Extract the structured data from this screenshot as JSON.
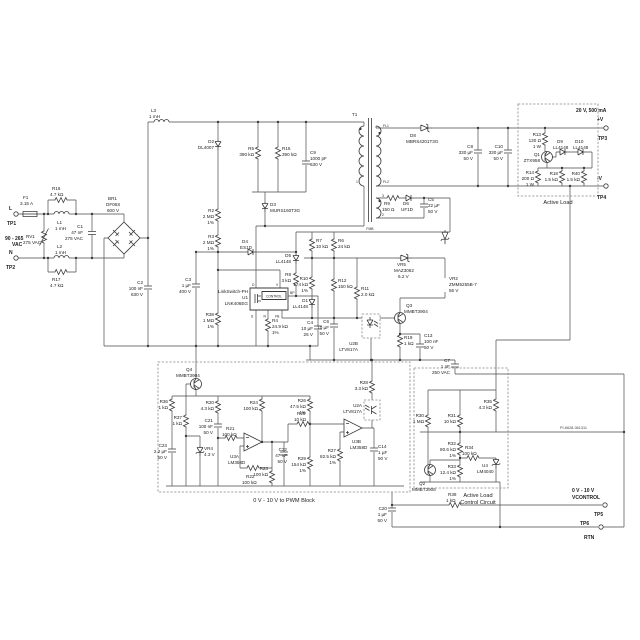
{
  "io": {
    "line": "L",
    "neutral": "N",
    "tp1": "TP1",
    "tp2": "TP2",
    "range1": "90 - 265",
    "range2": "VAC",
    "out_rating": "20 V, 500 mA",
    "out_pos": "+V",
    "tp3": "TP3",
    "out_neg": "-V",
    "tp4": "TP4",
    "ctrl_range": "0 V - 10 V",
    "ctrl_name": "VCONTROL",
    "tp5": "TP5",
    "tp6": "TP6",
    "rtn": "RTN"
  },
  "blocks": {
    "active_load": "Active Load",
    "pwm": "0 V - 10 V to PWM Block",
    "alcc1": "Active Load",
    "alcc2": "Control Circuit"
  },
  "doc": {
    "number": "PI-6628-061311"
  },
  "u1": {
    "brand": "LinkSwitch-PH",
    "ref": "U1",
    "part": "LNK406EG",
    "control": "CONTROL",
    "pin_d": "D",
    "pin_s": "S",
    "pin_bp": "BP",
    "pin_fb": "FB",
    "pin_v": "V",
    "pin_r": "R"
  },
  "t1": {
    "ref": "T1",
    "fl1": "FL1",
    "fl2": "FL2",
    "p1": "1",
    "p2": "2",
    "p3": "3",
    "fmb": "FMB"
  },
  "parts": {
    "F1": {
      "ref": "F1",
      "v1": "3.15 A"
    },
    "RV1": {
      "ref": "RV1",
      "v1": "275 VAC"
    },
    "R16": {
      "ref": "R16",
      "v1": "4.7 kΩ"
    },
    "R17": {
      "ref": "R17",
      "v1": "4.7 kΩ"
    },
    "L1": {
      "ref": "L1",
      "v1": "1 mH"
    },
    "L2": {
      "ref": "L2",
      "v1": "1 mH"
    },
    "L3": {
      "ref": "L3",
      "v1": "1 mH"
    },
    "C1": {
      "ref": "C1",
      "v1": "47 nF",
      "v2": "275 VAC"
    },
    "BR1": {
      "ref": "BR1",
      "v1": "DF06S",
      "v2": "600 V"
    },
    "C2": {
      "ref": "C2",
      "v1": "100 nF",
      "v2": "630 V"
    },
    "D2": {
      "ref": "D2",
      "v1": "DL4007"
    },
    "R2": {
      "ref": "R2",
      "v1": "2 MΩ",
      "v2": "1%"
    },
    "R3": {
      "ref": "R3",
      "v1": "2 MΩ",
      "v2": "1%"
    },
    "C3": {
      "ref": "C3",
      "v1": "1 µF",
      "v2": "400 V"
    },
    "R5": {
      "ref": "R5",
      "v1": "390 kΩ"
    },
    "R15": {
      "ref": "R15",
      "v1": "390 kΩ"
    },
    "C9": {
      "ref": "C9",
      "v1": "1000 pF",
      "v2": "630 V"
    },
    "D3": {
      "ref": "D3",
      "v1": "MURS160T3G"
    },
    "D4": {
      "ref": "D4",
      "v1": "ES1D"
    },
    "D5": {
      "ref": "D5",
      "v1": "LL4148"
    },
    "R8": {
      "ref": "R8",
      "v1": "3 kΩ"
    },
    "R38": {
      "ref": "R38",
      "v1": "1 MΩ",
      "v2": "1%"
    },
    "R4": {
      "ref": "R4",
      "v1": "24.9 kΩ",
      "v2": "1%"
    },
    "C4": {
      "ref": "C4",
      "v1": "10 µF",
      "v2": "25 V"
    },
    "R7": {
      "ref": "R7",
      "v1": "10 kΩ"
    },
    "R6": {
      "ref": "R6",
      "v1": "24 kΩ"
    },
    "VR5": {
      "ref": "VR5",
      "v1": "MAZ3062",
      "v2": "6.2 V"
    },
    "R10": {
      "ref": "R10",
      "v1": "174 kΩ",
      "v2": "1%"
    },
    "R12": {
      "ref": "R12",
      "v1": "150 kΩ"
    },
    "R11": {
      "ref": "R11",
      "v1": "2.0 kΩ"
    },
    "D1": {
      "ref": "D1",
      "v1": "LL4148"
    },
    "C6": {
      "ref": "C6",
      "v1": "10 µF",
      "v2": "50 V"
    },
    "VR2": {
      "ref": "VR2",
      "v1": "ZMM5255B-7",
      "v2": "56 V"
    },
    "Q3": {
      "ref": "Q3",
      "v1": "MMBT3904"
    },
    "U2B": {
      "ref": "U2B",
      "v1": "LTV817A"
    },
    "R19": {
      "ref": "R19",
      "v1": "1 kΩ"
    },
    "C13": {
      "ref": "C13",
      "v1": "100 nF",
      "v2": "50 V"
    },
    "C7": {
      "ref": "C7",
      "v1": "1 nF",
      "v2": "250 VAC"
    },
    "R9": {
      "ref": "R9",
      "v1": "150 Ω"
    },
    "D6": {
      "ref": "D6",
      "v1": "UF1D"
    },
    "C5": {
      "ref": "C5",
      "v1": "22 µF",
      "v2": "50 V"
    },
    "D8": {
      "ref": "D8",
      "v1": "MBRS4201T3G"
    },
    "C8": {
      "ref": "C8",
      "v1": "330 µF",
      "v2": "50 V"
    },
    "C10": {
      "ref": "C10",
      "v1": "330 µF",
      "v2": "50 V"
    },
    "R13": {
      "ref": "R13",
      "v1": "130 Ω",
      "v2": "1 W"
    },
    "Q1": {
      "ref": "Q1",
      "v1": "ZTX958"
    },
    "D9": {
      "ref": "D9",
      "v1": "LL4148"
    },
    "D10": {
      "ref": "D10",
      "v1": "LL4148"
    },
    "R14": {
      "ref": "R14",
      "v1": "200 Ω",
      "v2": "1 W"
    },
    "R18": {
      "ref": "R18",
      "v1": "1.5 kΩ"
    },
    "R40": {
      "ref": "R40",
      "v1": "1.5 kΩ"
    },
    "Q4": {
      "ref": "Q4",
      "v1": "MMBT3904"
    },
    "R36": {
      "ref": "R36",
      "v1": "1 kΩ"
    },
    "R37": {
      "ref": "R37",
      "v1": "1 kΩ"
    },
    "C23": {
      "ref": "C23",
      "v1": "2.2 µF",
      "v2": "50 V"
    },
    "VR4": {
      "ref": "VR4",
      "v1": "4.3 V"
    },
    "R20": {
      "ref": "R20",
      "v1": "4.3 kΩ"
    },
    "C21": {
      "ref": "C21",
      "v1": "100 nF",
      "v2": "50 V"
    },
    "R21": {
      "ref": "R21",
      "v1": "100 kΩ"
    },
    "R22": {
      "ref": "R22",
      "v1": "100 kΩ"
    },
    "R23": {
      "ref": "R23",
      "v1": "100 kΩ"
    },
    "R24": {
      "ref": "R24",
      "v1": "100 kΩ"
    },
    "U3A": {
      "ref": "U3A",
      "v1": "LM358D"
    },
    "U3B": {
      "ref": "U3B",
      "v1": "LM358D"
    },
    "C22": {
      "ref": "C22",
      "v1": "47 nF",
      "v2": "50 V"
    },
    "R26": {
      "ref": "R26",
      "v1": "47.5 kΩ",
      "v2": "1%"
    },
    "R25": {
      "ref": "R25",
      "v1": "10 kΩ"
    },
    "R29": {
      "ref": "R29",
      "v1": "154 kΩ",
      "v2": "1%"
    },
    "R28": {
      "ref": "R28",
      "v1": "3.3 kΩ"
    },
    "U2A": {
      "ref": "U2A",
      "v1": "LTV817A"
    },
    "R27": {
      "ref": "R27",
      "v1": "82.5 kΩ",
      "v2": "1%"
    },
    "C14": {
      "ref": "C14",
      "v1": "1 µF",
      "v2": "50 V"
    },
    "R30": {
      "ref": "R30",
      "v1": "1 MΩ"
    },
    "R31": {
      "ref": "R31",
      "v1": "10 kΩ"
    },
    "R35": {
      "ref": "R35",
      "v1": "4.3 kΩ"
    },
    "R32": {
      "ref": "R32",
      "v1": "80.6 kΩ",
      "v2": "1%"
    },
    "R34": {
      "ref": "R34",
      "v1": "100 kΩ"
    },
    "R33": {
      "ref": "R33",
      "v1": "12.4 kΩ",
      "v2": "1%"
    },
    "U4": {
      "ref": "U4",
      "v1": "LM4040"
    },
    "Q2": {
      "ref": "Q2",
      "v1": "MMBT3906"
    },
    "R39": {
      "ref": "R39",
      "v1": "1 kΩ"
    },
    "C20": {
      "ref": "C20",
      "v1": "1 µF",
      "v2": "50 V"
    }
  }
}
